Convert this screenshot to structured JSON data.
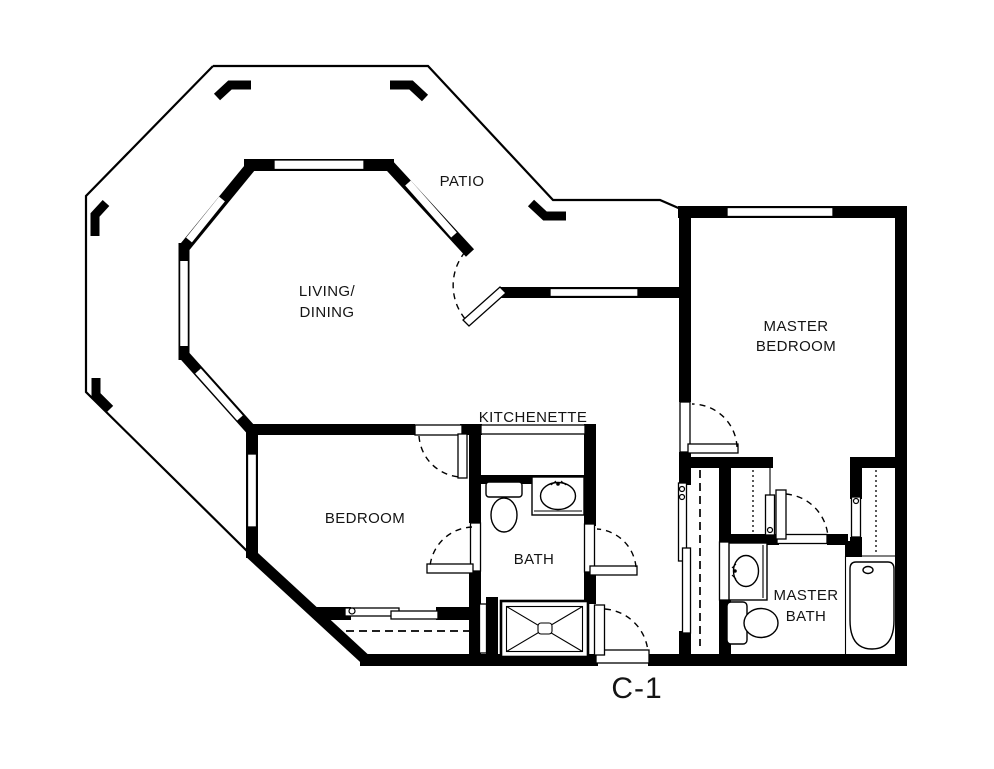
{
  "plan_label": "C-1",
  "colors": {
    "wall": "#000000",
    "background": "#ffffff",
    "text": "#141414"
  },
  "rooms": {
    "patio": "PATIO",
    "living_line1": "LIVING/",
    "living_line2": "DINING",
    "master_bedroom_line1": "MASTER",
    "master_bedroom_line2": "BEDROOM",
    "bedroom": "BEDROOM",
    "kitchenette": "KITCHENETTE",
    "bath": "BATH",
    "master_bath_line1": "MASTER",
    "master_bath_line2": "BATH"
  },
  "fixtures": {
    "bath": [
      "toilet",
      "sink-vanity",
      "shower-stall"
    ],
    "master_bath": [
      "sink-vanity",
      "toilet",
      "bathtub"
    ],
    "bedroom": [
      "sliding-door-closet"
    ],
    "hall": [
      "bypass-door-closet"
    ],
    "master_suite": [
      "wire-shelf-closet",
      "wire-shelf-closet"
    ]
  }
}
